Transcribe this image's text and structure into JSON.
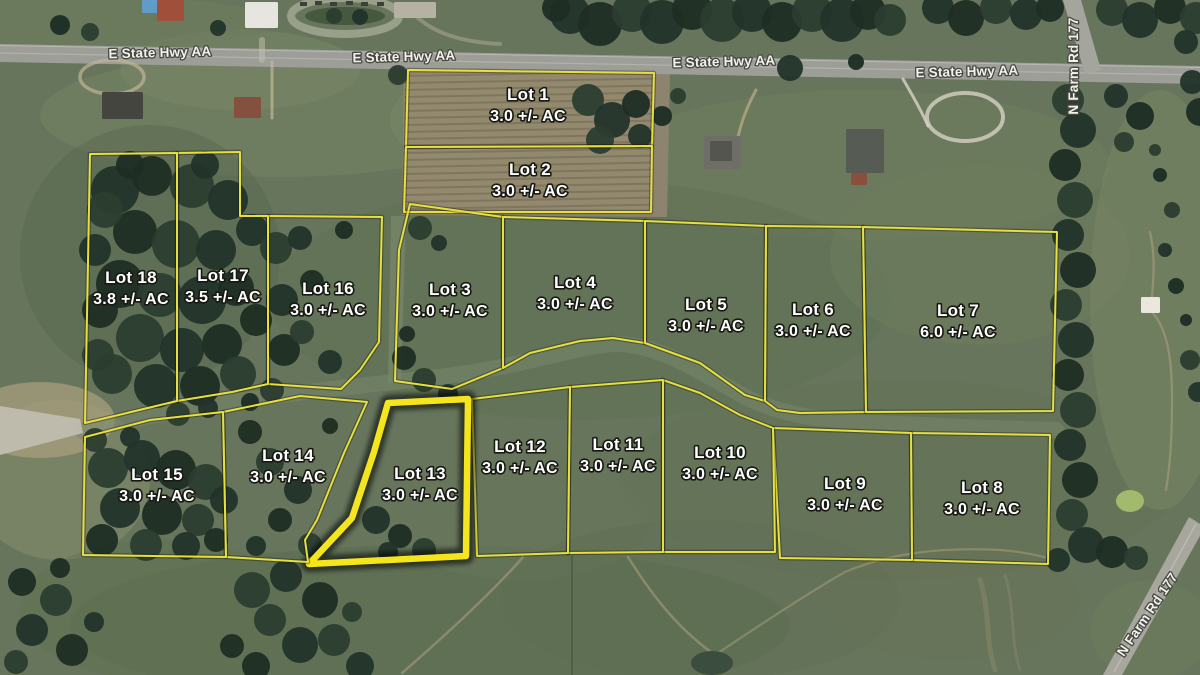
{
  "map": {
    "type": "satellite-plat",
    "highlighted_lot": "Lot 13",
    "colors": {
      "boundary": "#e6e03f",
      "highlight": "#f4e51d",
      "lot_label_fill": "#ffffff",
      "road_label_fill": "#f2f2ec",
      "field_green": "#64735a",
      "tilled_field": "#93896f",
      "highway_gray": "#9c9e97"
    },
    "roads": {
      "highway": {
        "label": "E State Hwy AA",
        "label_occurrences": 4
      },
      "farm_road": {
        "label": "N Farm Rd 177",
        "label_occurrences": 2
      }
    },
    "lots": [
      {
        "name": "Lot 1",
        "acreage": "3.0 +/- AC",
        "highlighted": false,
        "label": [
          528,
          105
        ],
        "polygon": [
          [
            408,
            70
          ],
          [
            654,
            73
          ],
          [
            652,
            146
          ],
          [
            406,
            147
          ]
        ]
      },
      {
        "name": "Lot 2",
        "acreage": "3.0 +/- AC",
        "highlighted": false,
        "label": [
          530,
          180
        ],
        "polygon": [
          [
            406,
            147
          ],
          [
            652,
            146
          ],
          [
            651,
            212
          ],
          [
            404,
            212
          ]
        ]
      },
      {
        "name": "Lot 3",
        "acreage": "3.0 +/- AC",
        "highlighted": false,
        "label": [
          450,
          300
        ],
        "polygon": [
          [
            410,
            204
          ],
          [
            503,
            217
          ],
          [
            503,
            368
          ],
          [
            452,
            389
          ],
          [
            395,
            381
          ],
          [
            399,
            250
          ]
        ]
      },
      {
        "name": "Lot 4",
        "acreage": "3.0 +/- AC",
        "highlighted": false,
        "label": [
          575,
          293
        ],
        "polygon": [
          [
            503,
            217
          ],
          [
            645,
            221
          ],
          [
            645,
            343
          ],
          [
            613,
            338
          ],
          [
            580,
            341
          ],
          [
            530,
            353
          ],
          [
            503,
            368
          ]
        ]
      },
      {
        "name": "Lot 5",
        "acreage": "3.0 +/- AC",
        "highlighted": false,
        "label": [
          706,
          315
        ],
        "polygon": [
          [
            645,
            221
          ],
          [
            766,
            226
          ],
          [
            765,
            401
          ],
          [
            745,
            395
          ],
          [
            700,
            363
          ],
          [
            645,
            343
          ]
        ]
      },
      {
        "name": "Lot 6",
        "acreage": "3.0 +/- AC",
        "highlighted": false,
        "label": [
          813,
          320
        ],
        "polygon": [
          [
            766,
            226
          ],
          [
            863,
            227
          ],
          [
            866,
            412
          ],
          [
            800,
            413
          ],
          [
            777,
            410
          ],
          [
            765,
            401
          ]
        ]
      },
      {
        "name": "Lot 7",
        "acreage": "6.0 +/- AC",
        "highlighted": false,
        "label": [
          958,
          321
        ],
        "polygon": [
          [
            863,
            227
          ],
          [
            1057,
            232
          ],
          [
            1053,
            411
          ],
          [
            866,
            412
          ]
        ]
      },
      {
        "name": "Lot 8",
        "acreage": "3.0 +/- AC",
        "highlighted": false,
        "label": [
          982,
          498
        ],
        "polygon": [
          [
            911,
            433
          ],
          [
            1050,
            435
          ],
          [
            1048,
            564
          ],
          [
            912,
            560
          ]
        ]
      },
      {
        "name": "Lot 9",
        "acreage": "3.0 +/- AC",
        "highlighted": false,
        "label": [
          845,
          494
        ],
        "polygon": [
          [
            773,
            428
          ],
          [
            911,
            433
          ],
          [
            912,
            560
          ],
          [
            780,
            558
          ]
        ]
      },
      {
        "name": "Lot 10",
        "acreage": "3.0 +/- AC",
        "highlighted": false,
        "label": [
          720,
          463
        ],
        "polygon": [
          [
            663,
            380
          ],
          [
            700,
            393
          ],
          [
            740,
            415
          ],
          [
            773,
            428
          ],
          [
            775,
            552
          ],
          [
            663,
            552
          ]
        ]
      },
      {
        "name": "Lot 11",
        "acreage": "3.0 +/- AC",
        "highlighted": false,
        "label": [
          618,
          455
        ],
        "polygon": [
          [
            570,
            387
          ],
          [
            663,
            380
          ],
          [
            663,
            552
          ],
          [
            568,
            553
          ]
        ]
      },
      {
        "name": "Lot 12",
        "acreage": "3.0 +/- AC",
        "highlighted": false,
        "label": [
          520,
          457
        ],
        "polygon": [
          [
            472,
            399
          ],
          [
            570,
            387
          ],
          [
            568,
            553
          ],
          [
            477,
            556
          ]
        ]
      },
      {
        "name": "Lot 13",
        "acreage": "3.0 +/- AC",
        "highlighted": true,
        "label": [
          420,
          484
        ],
        "polygon": [
          [
            388,
            403
          ],
          [
            468,
            399
          ],
          [
            466,
            556
          ],
          [
            309,
            564
          ],
          [
            352,
            518
          ],
          [
            374,
            452
          ]
        ]
      },
      {
        "name": "Lot 14",
        "acreage": "3.0 +/- AC",
        "highlighted": false,
        "label": [
          288,
          466
        ],
        "polygon": [
          [
            223,
            412
          ],
          [
            300,
            396
          ],
          [
            367,
            402
          ],
          [
            344,
            453
          ],
          [
            317,
            520
          ],
          [
            305,
            540
          ],
          [
            308,
            562
          ],
          [
            226,
            557
          ]
        ]
      },
      {
        "name": "Lot 15",
        "acreage": "3.0 +/- AC",
        "highlighted": false,
        "label": [
          157,
          485
        ],
        "polygon": [
          [
            85,
            437
          ],
          [
            150,
            420
          ],
          [
            223,
            412
          ],
          [
            226,
            557
          ],
          [
            83,
            555
          ]
        ]
      },
      {
        "name": "Lot 16",
        "acreage": "3.0 +/- AC",
        "highlighted": false,
        "label": [
          328,
          299
        ],
        "polygon": [
          [
            268,
            216
          ],
          [
            382,
            217
          ],
          [
            379,
            342
          ],
          [
            360,
            370
          ],
          [
            341,
            389
          ],
          [
            268,
            384
          ]
        ]
      },
      {
        "name": "Lot 17",
        "acreage": "3.5 +/- AC",
        "highlighted": false,
        "label": [
          223,
          286
        ],
        "polygon": [
          [
            177,
            153
          ],
          [
            240,
            152
          ],
          [
            240,
            216
          ],
          [
            268,
            216
          ],
          [
            268,
            384
          ],
          [
            232,
            392
          ],
          [
            177,
            401
          ]
        ]
      },
      {
        "name": "Lot 18",
        "acreage": "3.8 +/- AC",
        "highlighted": false,
        "label": [
          131,
          288
        ],
        "polygon": [
          [
            90,
            154
          ],
          [
            177,
            153
          ],
          [
            177,
            401
          ],
          [
            85,
            423
          ]
        ]
      }
    ]
  }
}
